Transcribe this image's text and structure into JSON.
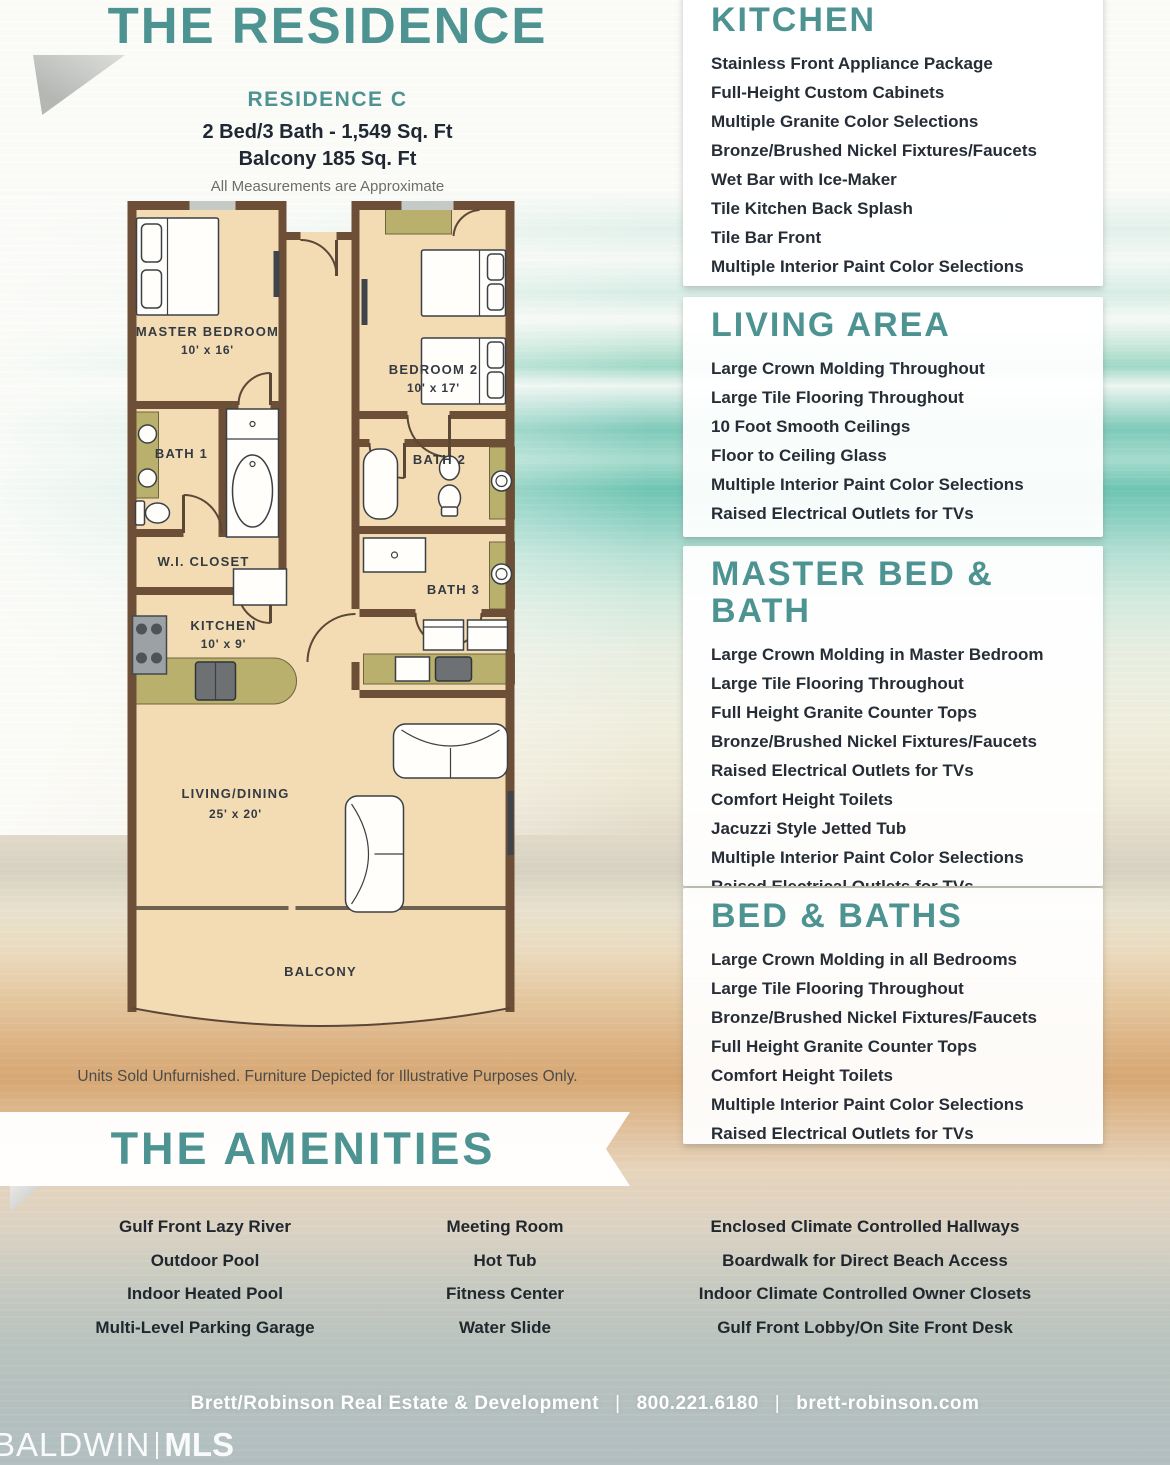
{
  "title": "THE RESIDENCE",
  "residence": {
    "name": "RESIDENCE C",
    "specs": "2 Bed/3 Bath - 1,549 Sq. Ft",
    "balcony": "Balcony 185 Sq. Ft",
    "note": "All Measurements are Approximate"
  },
  "floorplan": {
    "rooms": {
      "master": {
        "name": "MASTER BEDROOM",
        "dims": "10' x 16'"
      },
      "bedroom2": {
        "name": "BEDROOM 2",
        "dims": "10' x 17'"
      },
      "bath1": {
        "name": "BATH 1"
      },
      "bath2": {
        "name": "BATH 2"
      },
      "bath3": {
        "name": "BATH 3"
      },
      "wic": {
        "name": "W.I. CLOSET"
      },
      "kitchen": {
        "name": "KITCHEN",
        "dims": "10' x 9'"
      },
      "living": {
        "name": "LIVING/DINING",
        "dims": "25' x 20'"
      },
      "balcony": {
        "name": "BALCONY"
      }
    }
  },
  "disclaimer": "Units Sold Unfurnished. Furniture Depicted for Illustrative Purposes Only.",
  "amenities": {
    "title": "THE AMENITIES",
    "columns": [
      [
        "Gulf Front Lazy River",
        "Outdoor Pool",
        "Indoor Heated Pool",
        "Multi-Level Parking Garage"
      ],
      [
        "Meeting Room",
        "Hot Tub",
        "Fitness Center",
        "Water Slide"
      ],
      [
        "Enclosed Climate Controlled Hallways",
        "Boardwalk for Direct Beach Access",
        "Indoor Climate Controlled Owner Closets",
        "Gulf Front Lobby/On Site Front Desk"
      ]
    ]
  },
  "features": [
    {
      "title": "KITCHEN",
      "items": [
        "Stainless Front Appliance Package",
        "Full-Height Custom Cabinets",
        "Multiple Granite Color Selections",
        "Bronze/Brushed Nickel Fixtures/Faucets",
        "Wet Bar with Ice-Maker",
        "Tile Kitchen Back Splash",
        "Tile Bar Front",
        "Multiple Interior Paint Color Selections"
      ]
    },
    {
      "title": "LIVING AREA",
      "items": [
        "Large Crown Molding Throughout",
        "Large Tile Flooring Throughout",
        "10 Foot Smooth Ceilings",
        "Floor to Ceiling Glass",
        "Multiple Interior Paint Color Selections",
        "Raised Electrical Outlets for TVs"
      ]
    },
    {
      "title": "MASTER BED & BATH",
      "items": [
        "Large Crown Molding in Master Bedroom",
        "Large Tile Flooring Throughout",
        "Full Height Granite Counter Tops",
        "Bronze/Brushed Nickel Fixtures/Faucets",
        "Raised Electrical Outlets for TVs",
        "Comfort Height Toilets",
        "Jacuzzi Style Jetted Tub",
        "Multiple Interior Paint Color Selections",
        "Raised Electrical Outlets for TVs"
      ]
    },
    {
      "title": "BED & BATHS",
      "items": [
        "Large Crown Molding in all Bedrooms",
        "Large Tile Flooring Throughout",
        "Bronze/Brushed Nickel Fixtures/Faucets",
        "Full Height Granite Counter Tops",
        "Comfort Height Toilets",
        "Multiple Interior Paint Color Selections",
        "Raised Electrical Outlets for TVs"
      ]
    }
  ],
  "footer": {
    "company": "Brett/Robinson Real Estate & Development",
    "separator": "|",
    "phone": "800.221.6180",
    "website": "brett-robinson.com"
  },
  "watermark": {
    "left": "BALDWIN",
    "right": "MLS"
  },
  "colors": {
    "accent": "#4d9391",
    "ink": "#262d36",
    "wall": "#6d4e37",
    "floor": "#f3dcb4",
    "olive": "#b8b06c"
  }
}
